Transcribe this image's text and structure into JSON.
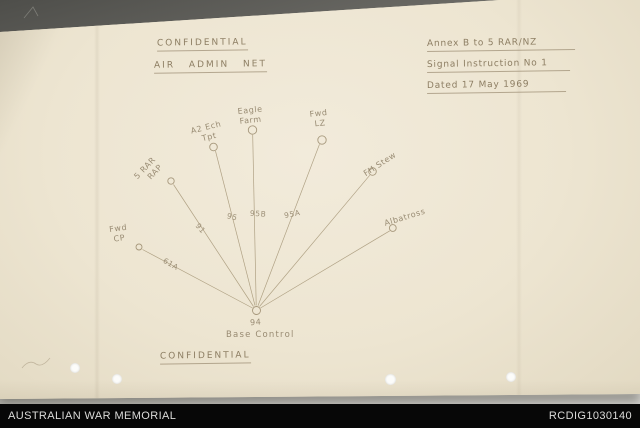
{
  "document": {
    "classification_top": "CONFIDENTIAL",
    "title": "AIR ADMIN NET",
    "annex_line1": "Annex B to 5 RAR/NZ",
    "annex_line2": "Signal Instruction No 1",
    "annex_line3": "Dated 17 May 1969",
    "classification_bottom": "CONFIDENTIAL"
  },
  "diagram": {
    "type": "radial-net",
    "hub": {
      "callsign": "94",
      "label": "Base Control"
    },
    "nodes": [
      {
        "lines": [
          "Fwd",
          "CP"
        ],
        "spoke": "61A"
      },
      {
        "lines": [
          "5 RAR",
          "RAP"
        ],
        "spoke": "91"
      },
      {
        "lines": [
          "A2 Ech",
          "Tpt"
        ],
        "spoke": "95"
      },
      {
        "lines": [
          "Eagle",
          "Farm"
        ],
        "spoke": "95B"
      },
      {
        "lines": [
          "Fwd",
          "LZ"
        ],
        "spoke": "95A"
      },
      {
        "lines": [
          "FH Stew"
        ],
        "spoke": ""
      },
      {
        "lines": [
          "Albatross"
        ],
        "spoke": ""
      }
    ]
  },
  "footer": {
    "institution": "AUSTRALIAN WAR MEMORIAL",
    "record_id": "RCDIG1030140"
  },
  "colors": {
    "paper": "#ede5d1",
    "ink": "#8d7e63",
    "footer_bg": "#070707",
    "footer_text": "#dcdcda"
  }
}
